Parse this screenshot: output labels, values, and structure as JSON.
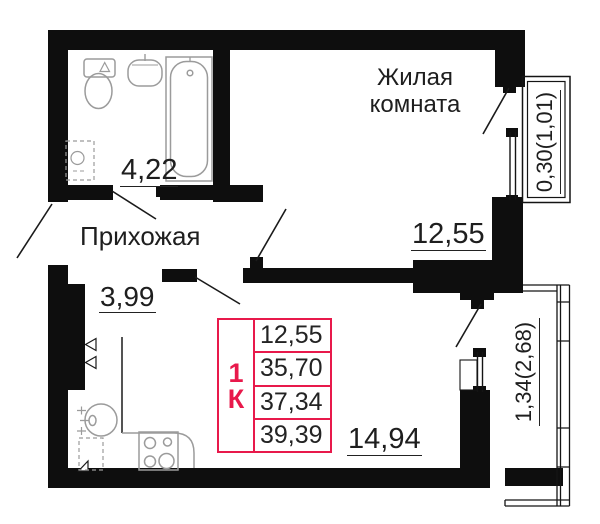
{
  "colors": {
    "wall": "#0e0e0e",
    "accent": "#e8194b",
    "fixture": "#9b9b9b",
    "ink": "#1e1e1e"
  },
  "labels": {
    "living_room": "Жилая\nкомната",
    "hallway": "Прихожая"
  },
  "dims": {
    "bathroom": "4,22",
    "hallway": "3,99",
    "living_room": "12,55",
    "kitchen_living": "14,94",
    "balcony_top": "0,30(1,01)",
    "balcony_bottom": "1,34(2,68)"
  },
  "card": {
    "type": "1К",
    "rows": [
      "12,55",
      "35,70",
      "37,34",
      "39,39"
    ]
  }
}
